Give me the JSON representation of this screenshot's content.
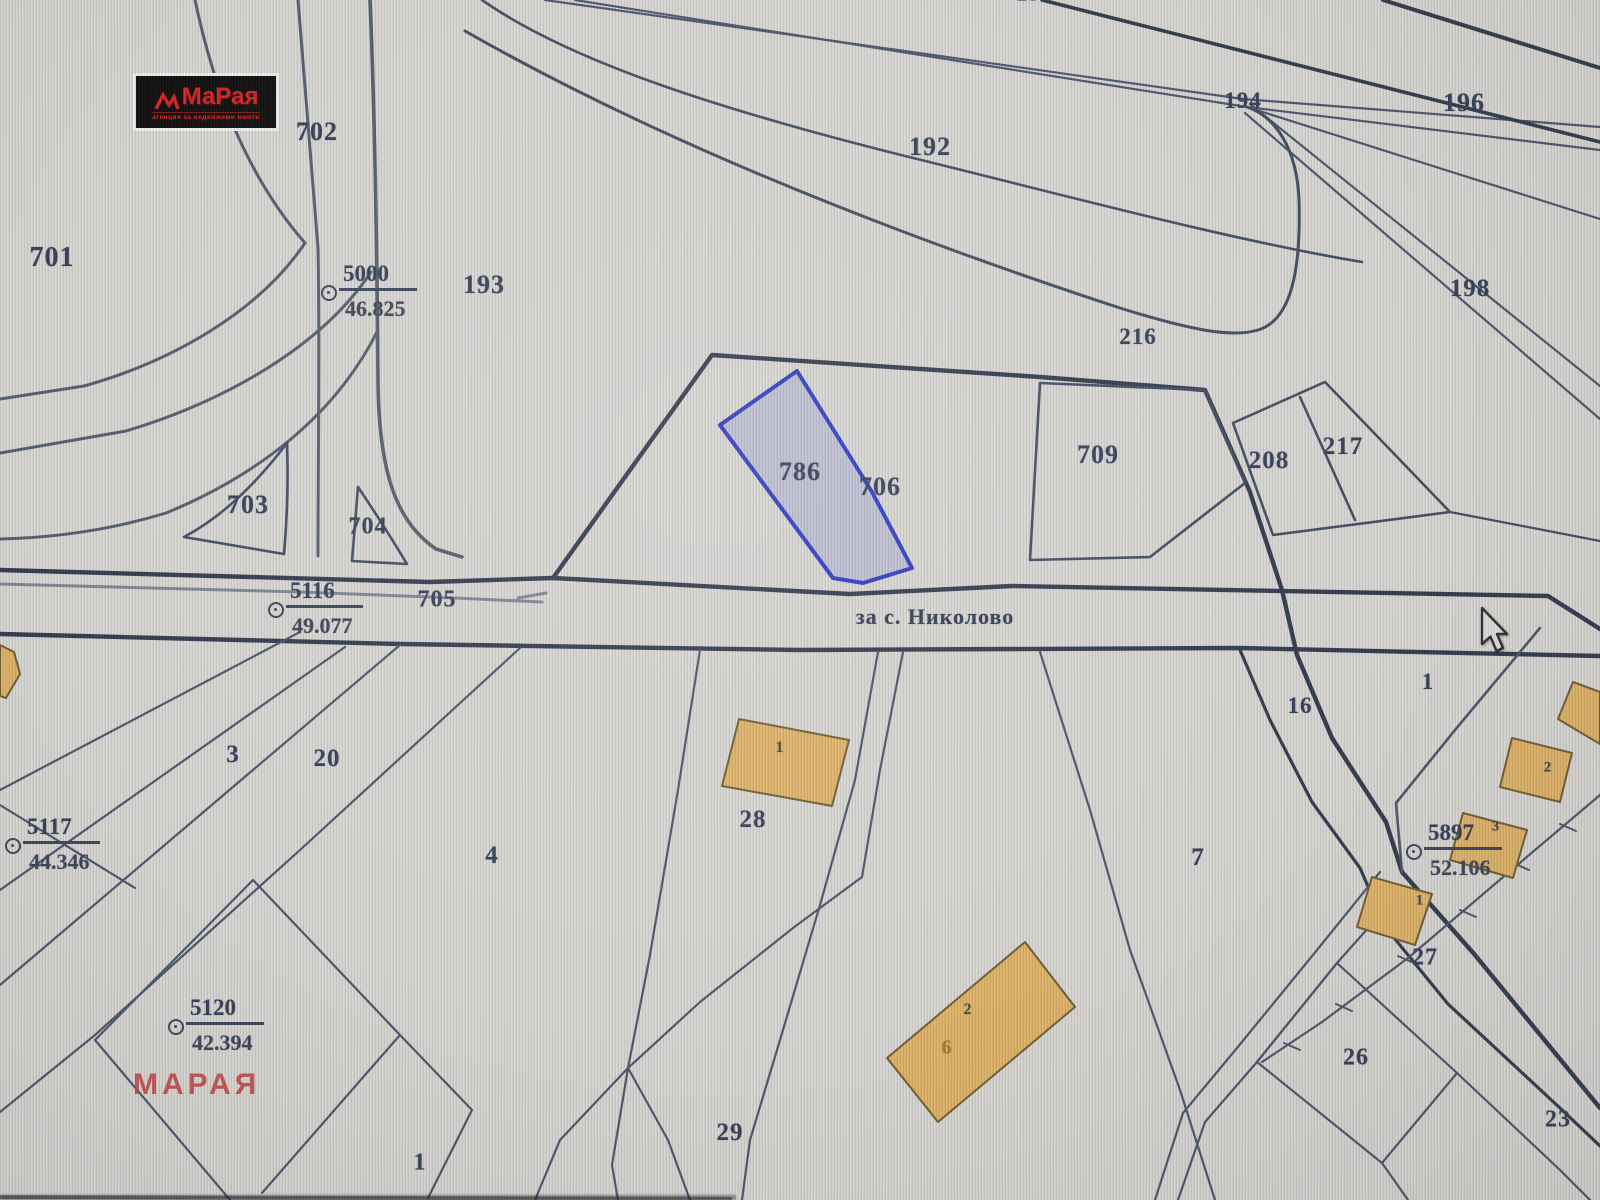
{
  "map": {
    "highlighted_parcel": "786",
    "road_label": "за с. Николово",
    "labels": [
      {
        "text": "195",
        "x": 1035,
        "y": -6,
        "s": 24
      },
      {
        "text": "702",
        "x": 317,
        "y": 132,
        "s": 26
      },
      {
        "text": "701",
        "x": 52,
        "y": 258,
        "s": 28
      },
      {
        "text": "193",
        "x": 484,
        "y": 285,
        "s": 26
      },
      {
        "text": "192",
        "x": 930,
        "y": 147,
        "s": 26
      },
      {
        "text": "194",
        "x": 1243,
        "y": 101,
        "s": 23
      },
      {
        "text": "196",
        "x": 1464,
        "y": 103,
        "s": 26
      },
      {
        "text": "198",
        "x": 1470,
        "y": 289,
        "s": 25
      },
      {
        "text": "216",
        "x": 1138,
        "y": 337,
        "s": 23
      },
      {
        "text": "786",
        "x": 800,
        "y": 472,
        "s": 26
      },
      {
        "text": "706",
        "x": 880,
        "y": 487,
        "s": 26
      },
      {
        "text": "709",
        "x": 1098,
        "y": 455,
        "s": 26
      },
      {
        "text": "208",
        "x": 1269,
        "y": 461,
        "s": 25
      },
      {
        "text": "217",
        "x": 1343,
        "y": 447,
        "s": 25
      },
      {
        "text": "703",
        "x": 248,
        "y": 505,
        "s": 26
      },
      {
        "text": "704",
        "x": 368,
        "y": 527,
        "s": 24
      },
      {
        "text": "705",
        "x": 437,
        "y": 600,
        "s": 24
      },
      {
        "text": "3",
        "x": 233,
        "y": 755,
        "s": 25
      },
      {
        "text": "20",
        "x": 327,
        "y": 759,
        "s": 25
      },
      {
        "text": "4",
        "x": 492,
        "y": 856,
        "s": 25
      },
      {
        "text": "28",
        "x": 753,
        "y": 820,
        "s": 25
      },
      {
        "text": "29",
        "x": 730,
        "y": 1133,
        "s": 25
      },
      {
        "text": "1",
        "x": 420,
        "y": 1163,
        "s": 24
      },
      {
        "text": "7",
        "x": 1198,
        "y": 858,
        "s": 25
      },
      {
        "text": "16",
        "x": 1300,
        "y": 706,
        "s": 23
      },
      {
        "text": "1",
        "x": 1428,
        "y": 682,
        "s": 23
      },
      {
        "text": "27",
        "x": 1425,
        "y": 958,
        "s": 24
      },
      {
        "text": "26",
        "x": 1356,
        "y": 1058,
        "s": 24
      },
      {
        "text": "23",
        "x": 1558,
        "y": 1120,
        "s": 24
      },
      {
        "text": "1",
        "x": 780,
        "y": 748,
        "s": 16,
        "c": "#4a4a2c"
      },
      {
        "text": "2",
        "x": 968,
        "y": 1010,
        "s": 16,
        "c": "#474747"
      },
      {
        "text": "6",
        "x": 947,
        "y": 1048,
        "s": 20,
        "c": "#a87b20"
      },
      {
        "text": "2",
        "x": 1548,
        "y": 768,
        "s": 15,
        "c": "#474747"
      },
      {
        "text": "3",
        "x": 1496,
        "y": 827,
        "s": 15,
        "c": "#474747"
      },
      {
        "text": "1",
        "x": 1420,
        "y": 901,
        "s": 15,
        "c": "#474747"
      }
    ],
    "survey_points": [
      {
        "id": "5000",
        "value": "46.825",
        "x": 329,
        "y": 293
      },
      {
        "id": "5116",
        "value": "49.077",
        "x": 276,
        "y": 610
      },
      {
        "id": "5117",
        "value": "44.346",
        "x": 13,
        "y": 846
      },
      {
        "id": "5120",
        "value": "42.394",
        "x": 176,
        "y": 1027
      },
      {
        "id": "5897",
        "value": "52.106",
        "x": 1414,
        "y": 852
      }
    ]
  },
  "logo": {
    "brand": "МаРая",
    "tagline": "агенция за недвижими имоти"
  },
  "watermark": {
    "text": "МАРАЯ"
  },
  "cursor": {
    "x": 1480,
    "y": 606
  },
  "colors": {
    "background": "#d8d6d3",
    "map_line": "#49536a",
    "road_line": "#2e384a",
    "label_text": "#323c55",
    "highlight_stroke": "#2b36c4",
    "highlight_fill": "rgba(168,172,212,0.55)",
    "building_fill": "#dfb266",
    "building_stroke": "#6e5c2f",
    "logo_red": "#d6201f",
    "watermark_red": "#c2413e"
  }
}
